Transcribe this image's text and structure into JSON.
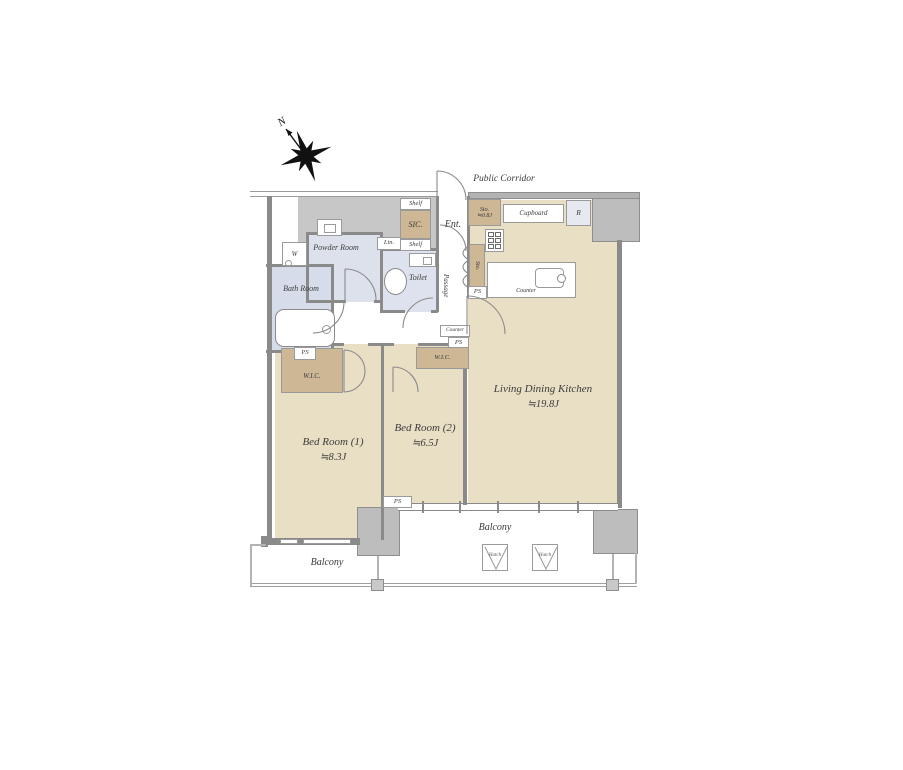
{
  "compass": {
    "north": "N"
  },
  "header": {
    "public_corridor": "Public Corridor"
  },
  "rooms": {
    "ldk": {
      "name": "Living Dining Kitchen",
      "size": "≒19.8J"
    },
    "bedroom1": {
      "name": "Bed Room (1)",
      "size": "≒8.3J"
    },
    "bedroom2": {
      "name": "Bed Room (2)",
      "size": "≒6.5J"
    },
    "powder": {
      "name": "Powder Room"
    },
    "bath": {
      "name": "Bath Room"
    },
    "toilet": {
      "name": "Toilet"
    },
    "entrance": {
      "name": "Ent."
    },
    "passage": {
      "name": "Passage"
    },
    "balcony_left": {
      "name": "Balcony"
    },
    "balcony_right": {
      "name": "Balcony"
    }
  },
  "storage": {
    "sic": "SIC.",
    "shelf_top": "Shelf",
    "shelf_bottom": "Shelf",
    "linen": "Lin.",
    "wic_bedroom1": "W.I.C.",
    "wic_bedroom2": "W.I.C.",
    "sto_entry_name": "Sto.",
    "sto_entry_size": "≒0.8J",
    "sto_kitchen": "Sto.",
    "cupboard": "Cupboard",
    "refrigerator": "R"
  },
  "kitchen": {
    "counter": "Counter"
  },
  "fixtures": {
    "washer": "W",
    "counter_small": "Counter"
  },
  "ps": [
    "PS",
    "PS",
    "PS",
    "PS"
  ],
  "hatch_labels": [
    "Hatch",
    "Hatch"
  ],
  "colors": {
    "floor_beige": "#e9dfc5",
    "closet_tan": "#cdb794",
    "wet_area_blue": "#dce1ec",
    "bath_blue": "#d6dce9",
    "wall_gray": "#8a8a8a",
    "column_gray": "#bdbdbd",
    "zone_gray": "#c7c7c7"
  }
}
